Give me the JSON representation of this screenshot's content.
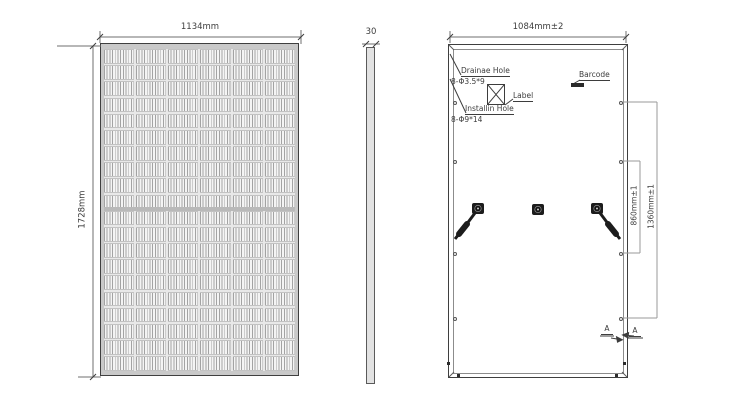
{
  "front_view": {
    "width_dim": "1134mm",
    "height_dim": "1728mm",
    "cell_columns": 6,
    "cell_rows": 20
  },
  "side_view": {
    "thickness_dim": "30"
  },
  "back_view": {
    "width_dim": "1084mm±2",
    "hole_span_dim": "860mm±1",
    "outer_hole_span_dim": "1360mm±1",
    "drainage_hole_label": "Drainae Hole",
    "drainage_hole_spec": "8-Φ3.5*9",
    "install_hole_label": "Installin Hole",
    "install_hole_spec": "8-Φ9*14",
    "label_callout": "Label",
    "barcode_callout": "Barcode",
    "section_marker": "A"
  },
  "colors": {
    "line": "#3a3a3a",
    "dim_line": "#6f6f6f",
    "cell_line": "#a3a3a3",
    "frame_fill": "#c9c9c9",
    "component_dark": "#1c1c1c"
  }
}
